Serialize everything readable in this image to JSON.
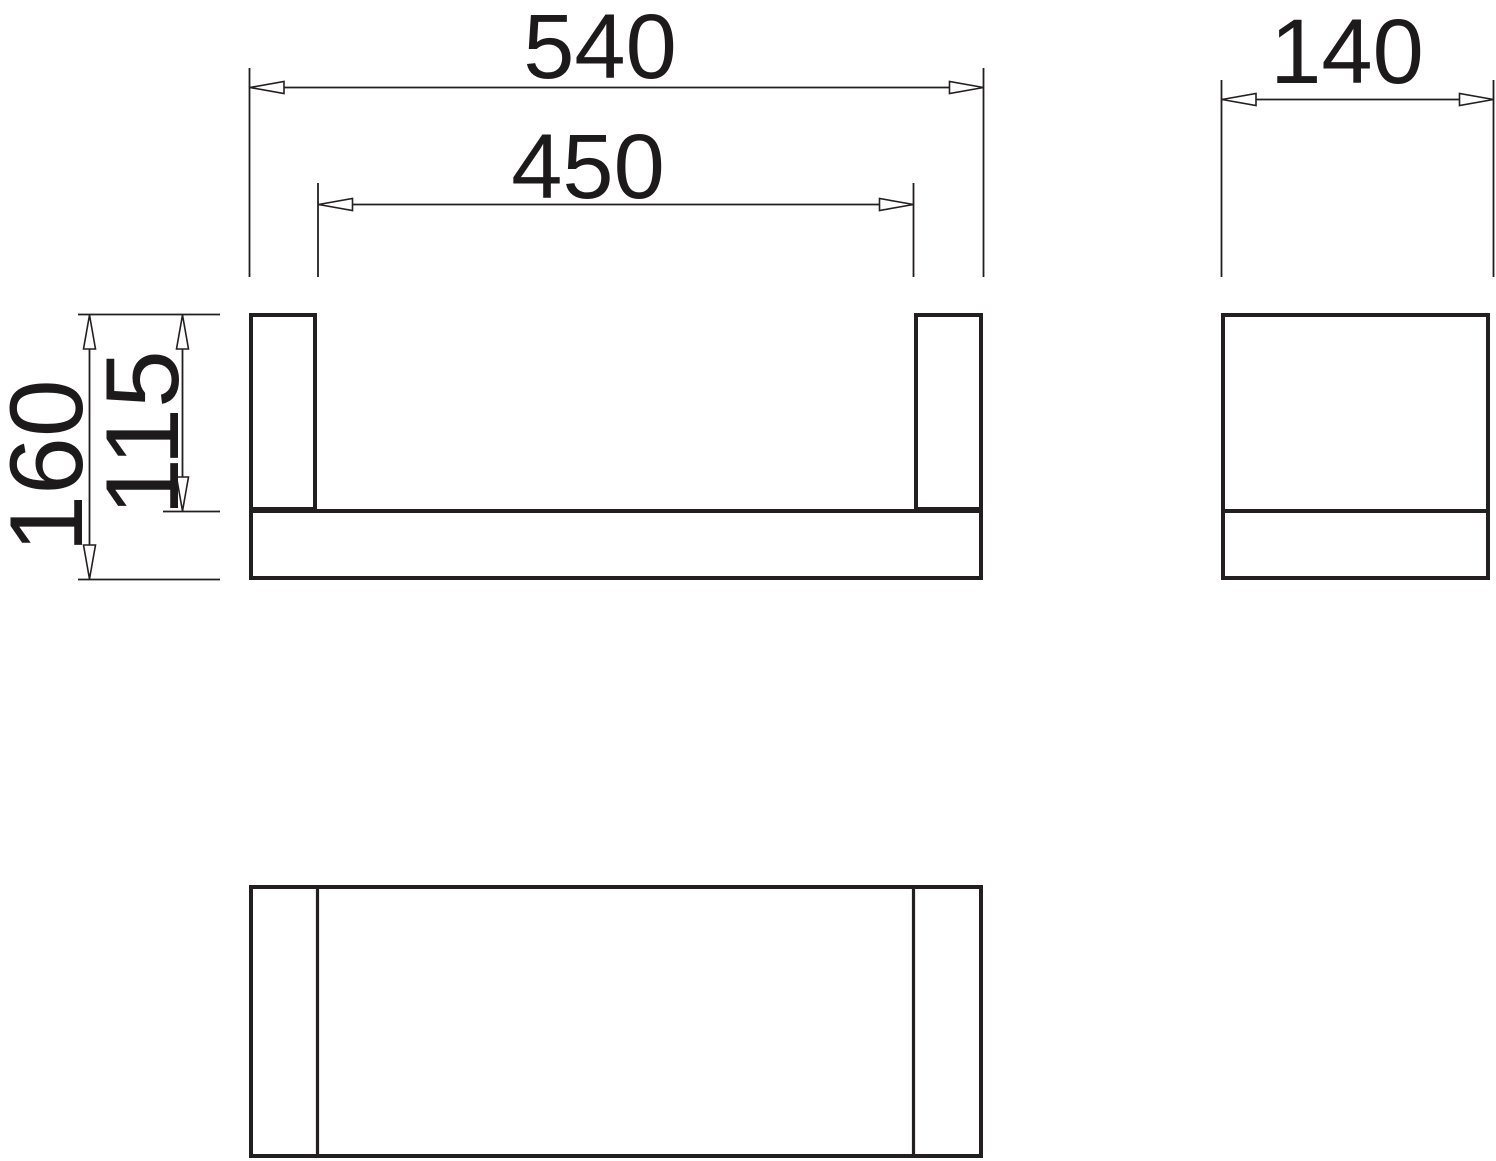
{
  "drawing": {
    "background_color": "#ffffff",
    "line_color": "#231f20",
    "text_color": "#1d1a1b",
    "views": {
      "front_view": "front elevation of rail with two end posts on a crossbar",
      "side_view": "side elevation rectangle with bottom bar line",
      "plan_view": "top view rectangle with two post section lines"
    },
    "dimensions": {
      "overall_width": "540",
      "inner_width": "450",
      "depth": "140",
      "overall_height": "160",
      "inner_height": "115"
    }
  }
}
